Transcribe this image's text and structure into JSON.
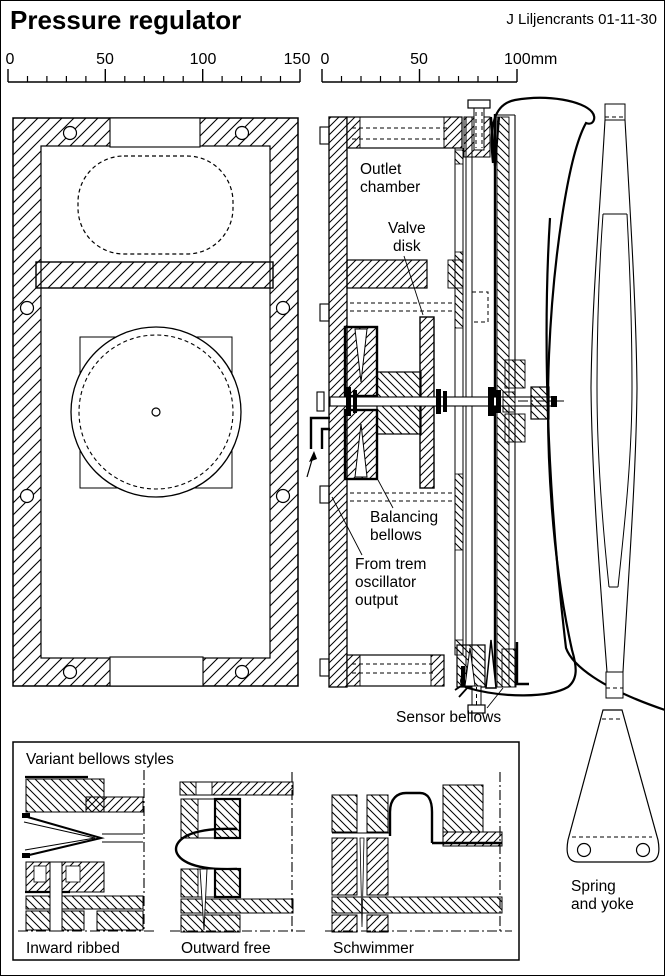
{
  "header": {
    "title": "Pressure regulator",
    "credit": "J Liljencrants 01-11-30"
  },
  "rulers": {
    "left": {
      "labels": [
        "0",
        "50",
        "100",
        "150"
      ]
    },
    "right": {
      "labels": [
        "0",
        "50",
        "100mm"
      ]
    }
  },
  "labels": {
    "outlet_chamber": [
      "Outlet",
      "chamber"
    ],
    "valve_disk": [
      "Valve",
      "disk"
    ],
    "balancing_bellows": [
      "Balancing",
      "bellows"
    ],
    "from_trem": [
      "From trem",
      "oscillator",
      "output"
    ],
    "sensor_bellows": "Sensor bellows",
    "spring_yoke": [
      "Spring",
      "and yoke"
    ]
  },
  "variants": {
    "title": "Variant bellows styles",
    "items": [
      "Inward ribbed",
      "Outward free",
      "Schwimmer"
    ]
  },
  "colors": {
    "ink": "#000000",
    "paper": "#ffffff"
  }
}
